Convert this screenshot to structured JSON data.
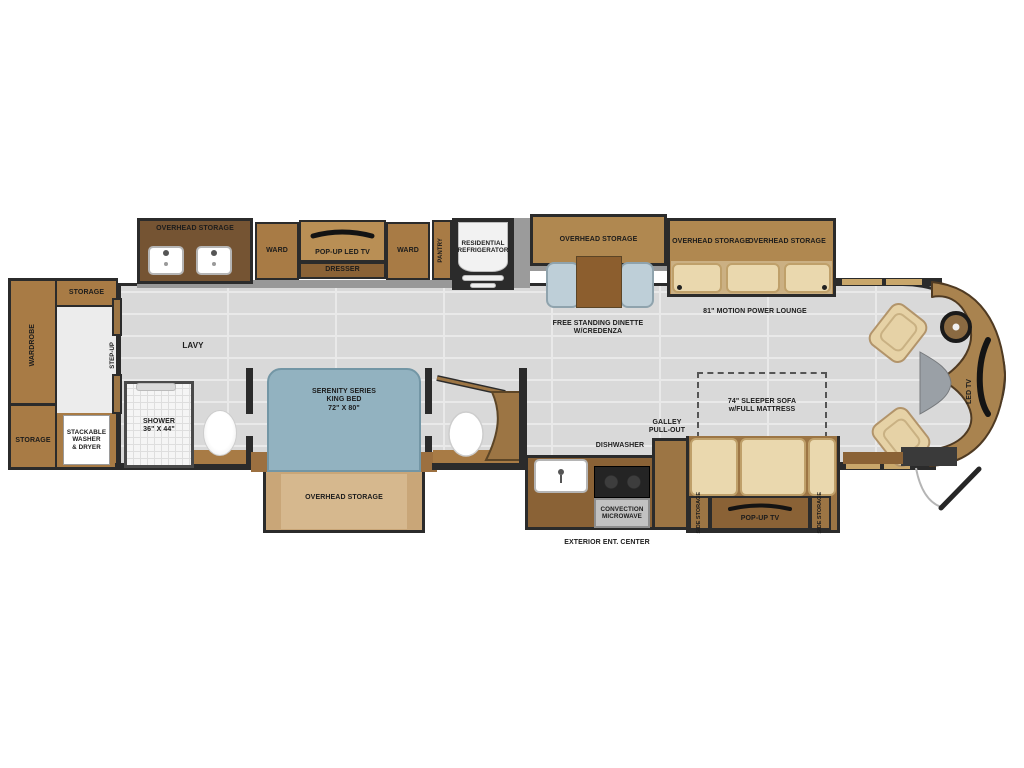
{
  "plan": {
    "rear": {
      "wardrobe": "WARDROBE",
      "storage_top": "STORAGE",
      "storage_bottom": "STORAGE",
      "washer": "STACKABLE\nWASHER\n& DRYER",
      "step_up": "STEP-UP"
    },
    "bath": {
      "lavy": "LAVY",
      "overhead_storage": "OVERHEAD STORAGE",
      "shower": "SHOWER\n36\" X 44\""
    },
    "bedroom": {
      "ward_left": "WARD",
      "tv": "POP-UP LED TV",
      "dresser": "DRESSER",
      "ward_right": "WARD",
      "pantry": "PANTRY",
      "bed": "SERENITY SERIES\nKING BED\n72\" X 80\"",
      "overhead_storage": "OVERHEAD STORAGE"
    },
    "kitchen": {
      "fridge": "RESIDENTIAL\nREFRIGERATOR",
      "dishwasher": "DISHWASHER",
      "galley": "GALLEY\nPULL-OUT",
      "microwave": "CONVECTION\nMICROWAVE",
      "exterior": "EXTERIOR ENT. CENTER"
    },
    "dinette": {
      "overhead_storage": "OVERHEAD STORAGE",
      "label": "FREE STANDING DINETTE\nW/CREDENZA"
    },
    "lounge": {
      "overhead_storage_1": "OVERHEAD STORAGE",
      "overhead_storage_2": "OVERHEAD STORAGE",
      "label": "81\" MOTION POWER LOUNGE"
    },
    "living": {
      "sofa": "74\" SLEEPER SOFA\nw/FULL MATTRESS",
      "pop_up_tv": "POP-UP TV",
      "side_storage_left": "SIDE STORAGE",
      "side_storage_right": "SIDE STORAGE"
    },
    "cab": {
      "led_tv": "LED TV"
    }
  },
  "colors": {
    "floor": "#d9d9d9",
    "wall": "#2b2b2b",
    "cabinet": "#a87b45",
    "cabinet_light": "#b08850",
    "cabinet_dark": "#755433",
    "counter": "#8a6236",
    "bed_blue": "#92b2c0",
    "cushion_tan": "#ead8ae",
    "chair_blue": "#becfd8",
    "storage_box": "#c9a678",
    "window_tan": "#c9a76b"
  }
}
